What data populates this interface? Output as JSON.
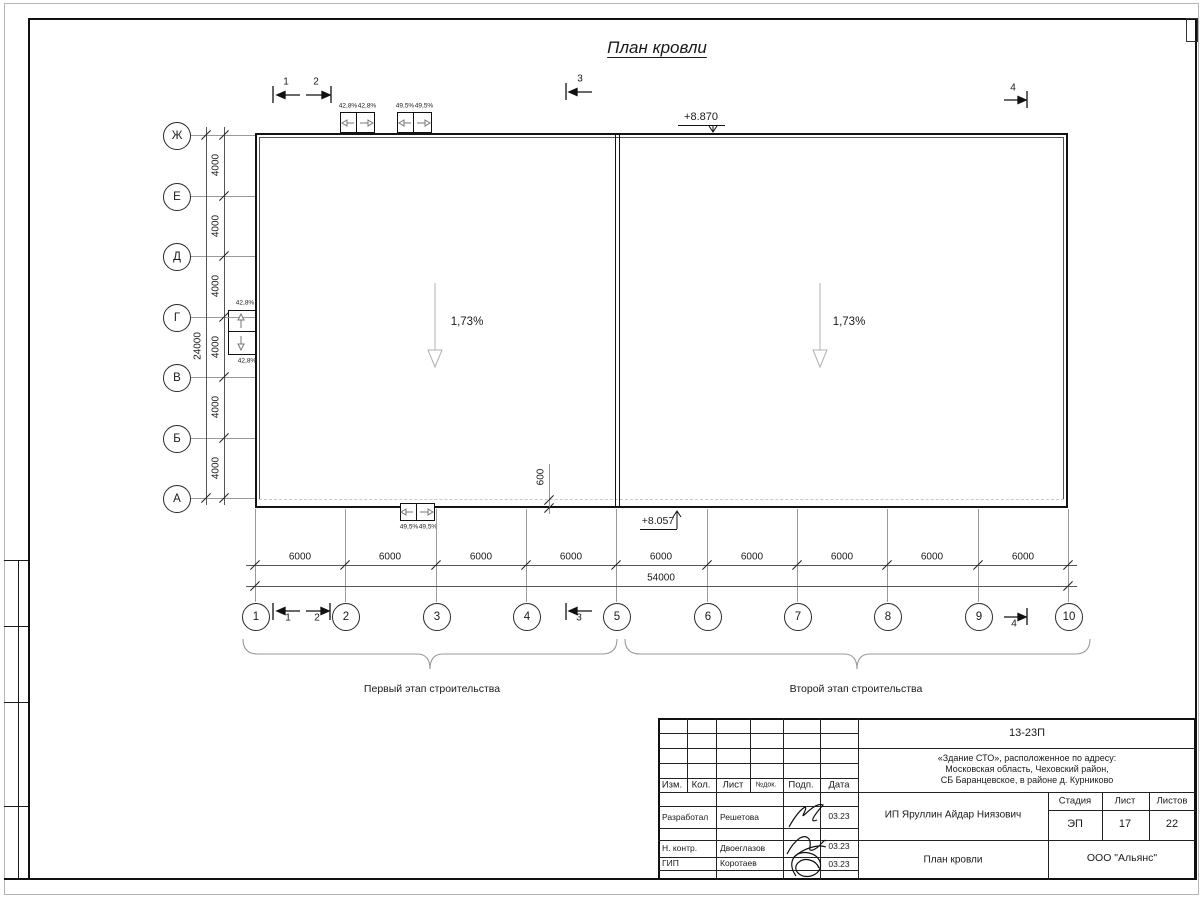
{
  "drawing": {
    "title": "План кровли",
    "slope_left": "1,73%",
    "slope_right": "1,73%",
    "elev_top": "+8.870",
    "elev_bottom": "+8.057",
    "axes": {
      "letters": [
        "Ж",
        "Е",
        "Д",
        "Г",
        "В",
        "Б",
        "А"
      ],
      "numbers": [
        "1",
        "2",
        "3",
        "4",
        "5",
        "6",
        "7",
        "8",
        "9",
        "10"
      ]
    },
    "sections": {
      "s1": "1",
      "s2": "2",
      "s3": "3",
      "s4": "4"
    },
    "dims": {
      "step_v": "4000",
      "total_v": "24000",
      "step_h": "6000",
      "total_h": "54000",
      "parapet": "600"
    },
    "funnels": {
      "top_1a": "42,8%",
      "top_1b": "42,8%",
      "top_2a": "49,5%",
      "top_2b": "49,5%",
      "left_a": "42,8%",
      "left_b": "42,8%",
      "bottom_a": "49,5%",
      "bottom_b": "49,5%"
    },
    "stages": {
      "first": "Первый этап строительства",
      "second": "Второй этап строительства"
    }
  },
  "titleblock": {
    "doc_number": "13-23П",
    "project_address_line1": "«Здание СТО», расположенное по адресу:",
    "project_address_line2": "Московская область, Чеховский район,",
    "project_address_line3": "СБ Баранцевское, в районе д. Курниково",
    "header_cols": [
      "Изм.",
      "Кол.",
      "Лист",
      "№док.",
      "Подп.",
      "Дата"
    ],
    "rows": [
      {
        "role": "Разработал",
        "name": "Решетова",
        "date": "03.23"
      },
      {
        "role": "Н. контр.",
        "name": "Двоеглазов",
        "date": "03.23"
      },
      {
        "role": "ГИП",
        "name": "Коротаев",
        "date": "03.23"
      }
    ],
    "client": "ИП Яруллин Айдар Ниязович",
    "sheet_name": "План кровли",
    "stage_label": "Стадия",
    "sheet_label": "Лист",
    "sheets_label": "Листов",
    "stage_value": "ЭП",
    "sheet_value": "17",
    "sheets_value": "22",
    "company": "ООО \"Альянс\""
  }
}
